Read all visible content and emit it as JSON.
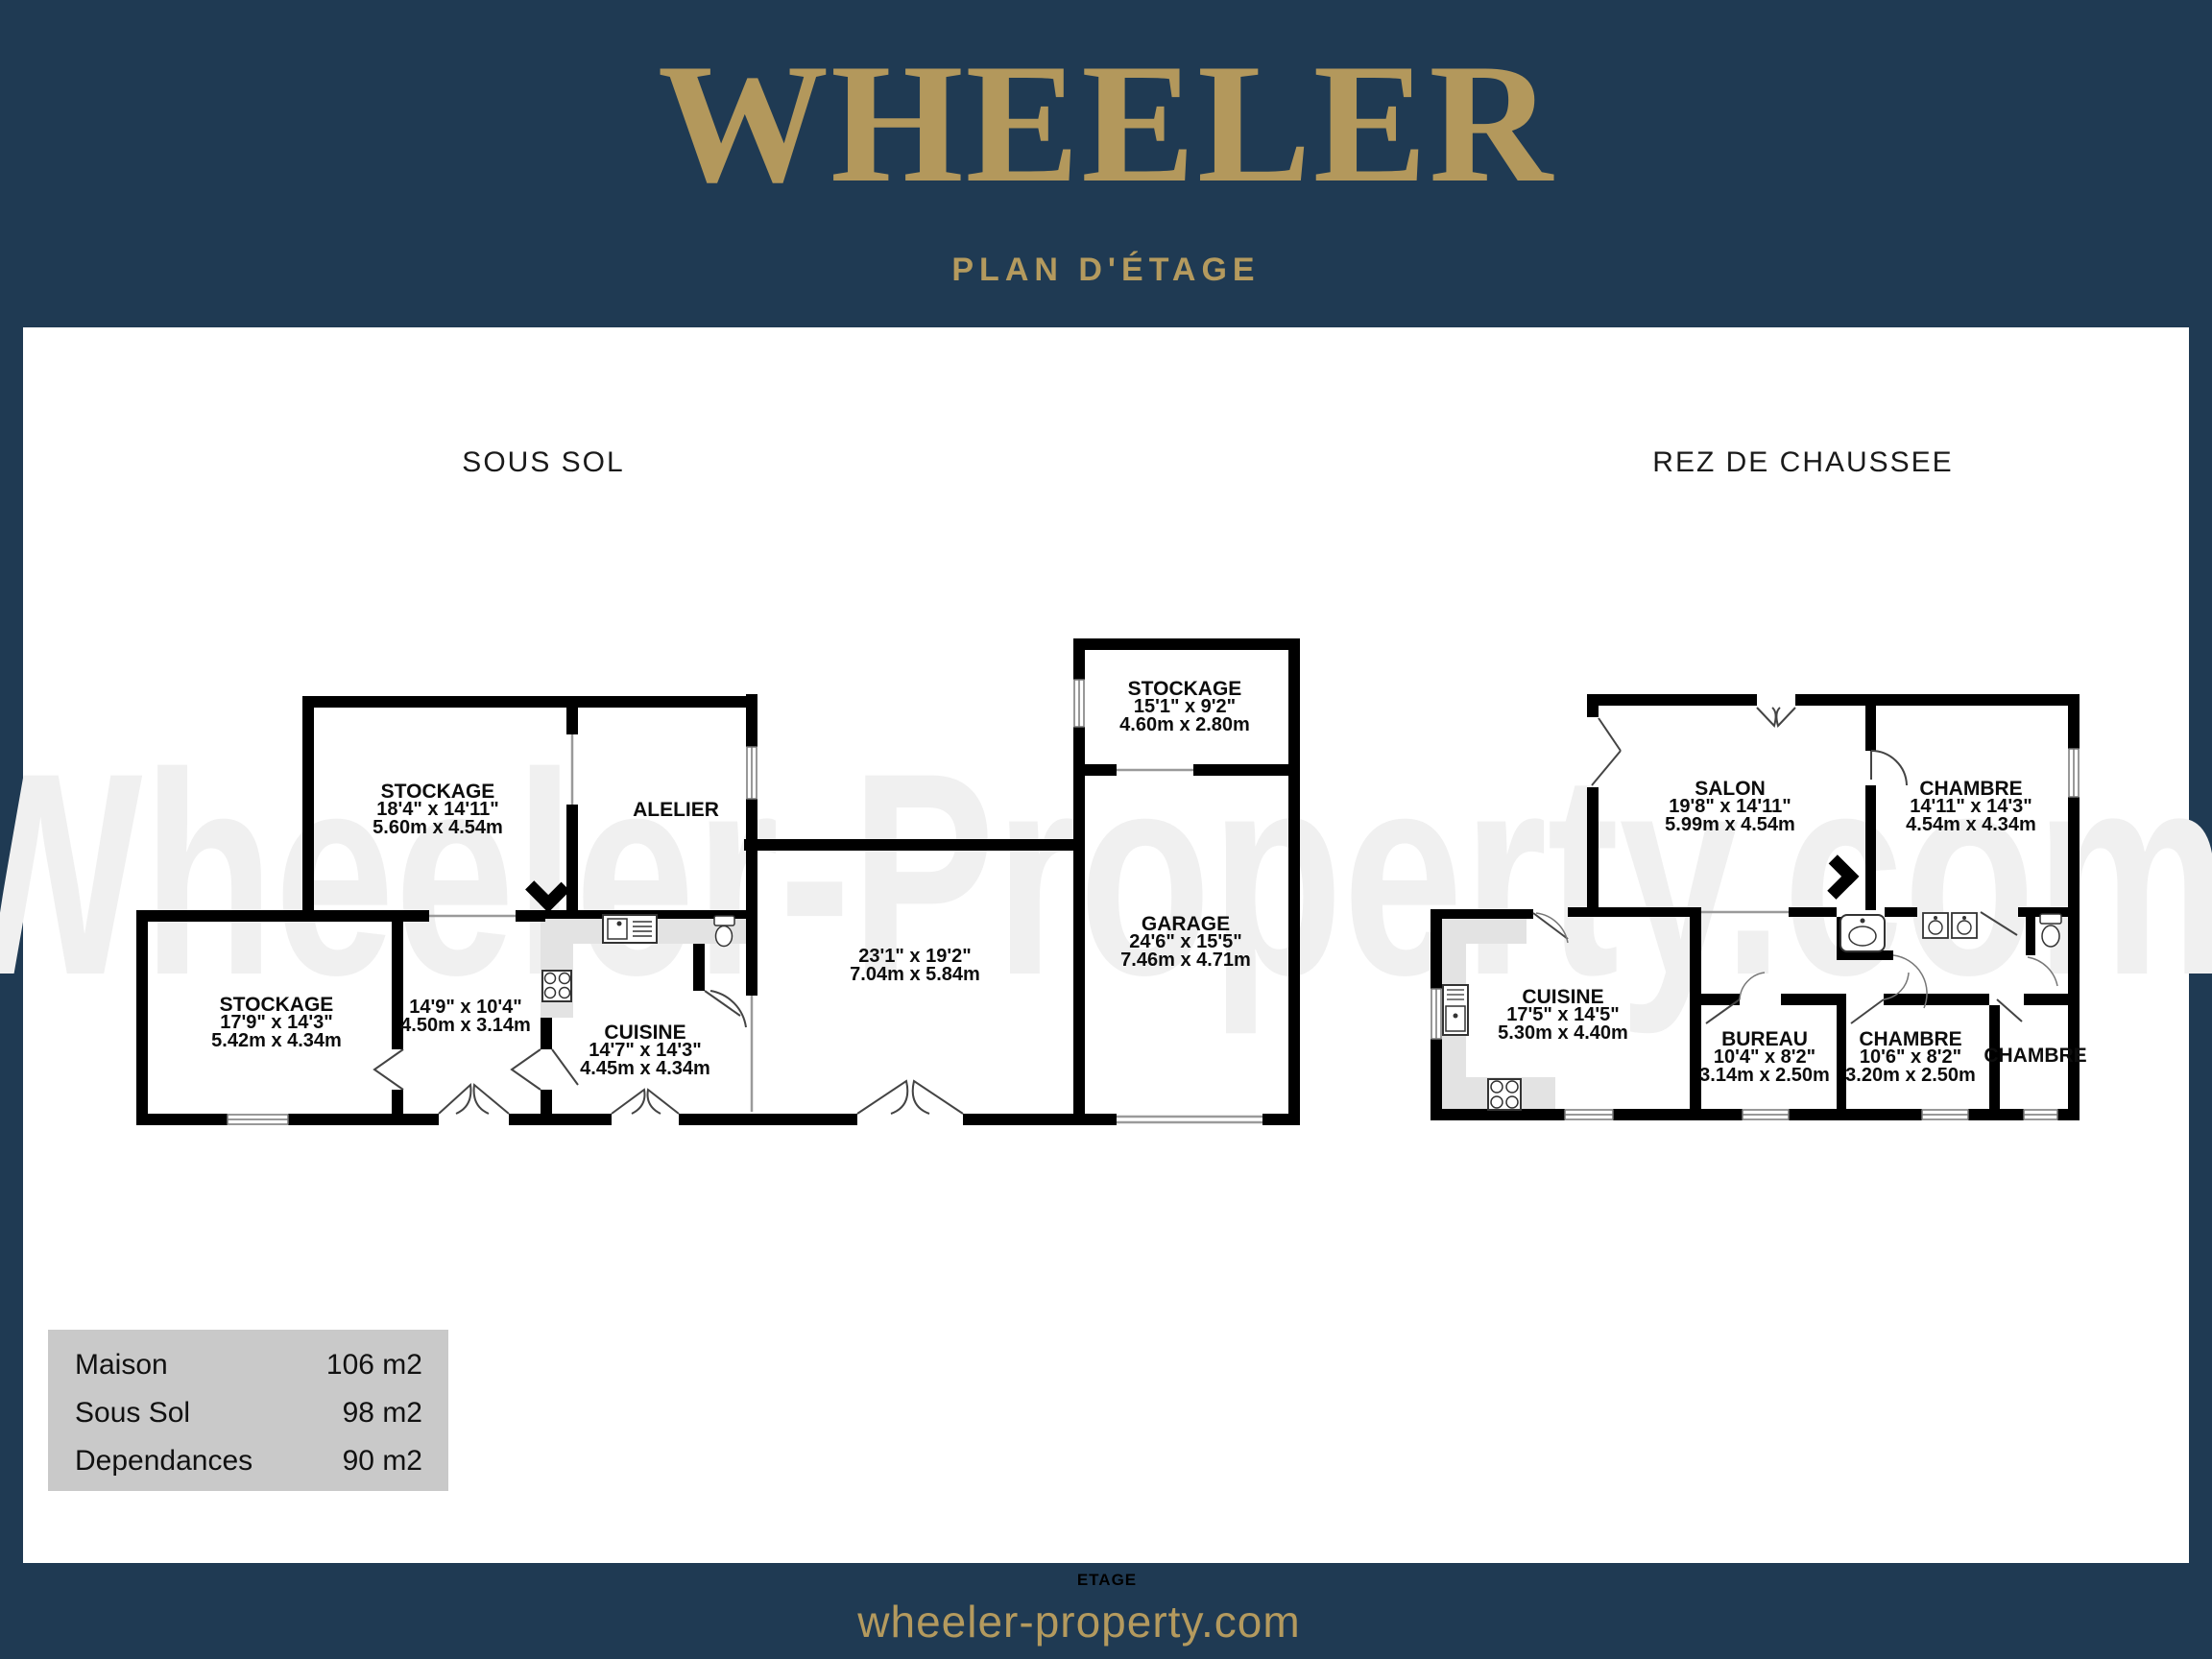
{
  "header": {
    "title": "WHEELER",
    "subtitle": "PLAN D'ÉTAGE"
  },
  "watermark": {
    "text": "Wheeler-Property.com"
  },
  "plans": [
    {
      "title": "SOUS SOL",
      "rooms": [
        {
          "name": "STOCKAGE",
          "imperial": "18'4\"  x 14'11\"",
          "metric": "5.60m  x 4.54m"
        },
        {
          "name": "ALELIER",
          "imperial": "",
          "metric": ""
        },
        {
          "name": "STOCKAGE",
          "imperial": "17'9\"  x 14'3\"",
          "metric": "5.42m  x 4.34m"
        },
        {
          "name": "",
          "imperial": "14'9\"  x 10'4\"",
          "metric": "4.50m  x 3.14m"
        },
        {
          "name": "CUISINE",
          "imperial": "14'7\"  x 14'3\"",
          "metric": "4.45m  x 4.34m"
        },
        {
          "name": "",
          "imperial": "23'1\"  x 19'2\"",
          "metric": "7.04m  x 5.84m"
        },
        {
          "name": "STOCKAGE",
          "imperial": "15'1\"  x 9'2\"",
          "metric": "4.60m  x 2.80m"
        },
        {
          "name": "GARAGE",
          "imperial": "24'6\"  x 15'5\"",
          "metric": "7.46m  x 4.71m"
        }
      ]
    },
    {
      "title": "REZ DE CHAUSSEE",
      "rooms": [
        {
          "name": "SALON",
          "imperial": "19'8\"  x 14'11\"",
          "metric": "5.99m  x 4.54m"
        },
        {
          "name": "CHAMBRE",
          "imperial": "14'11\"  x 14'3\"",
          "metric": "4.54m  x 4.34m"
        },
        {
          "name": "CUISINE",
          "imperial": "17'5\"  x 14'5\"",
          "metric": "5.30m  x 4.40m"
        },
        {
          "name": "BUREAU",
          "imperial": "10'4\"  x 8'2\"",
          "metric": "3.14m  x 2.50m"
        },
        {
          "name": "CHAMBRE",
          "imperial": "10'6\"  x 8'2\"",
          "metric": "3.20m  x 2.50m"
        },
        {
          "name": "CHAMBRE",
          "imperial": "",
          "metric": ""
        }
      ]
    }
  ],
  "legend": {
    "rows": [
      {
        "label": "Maison",
        "value": "106 m2"
      },
      {
        "label": "Sous Sol",
        "value": "98 m2"
      },
      {
        "label": "Dependances",
        "value": "90 m2"
      }
    ]
  },
  "footer": {
    "floor_label": "ETAGE",
    "url": "wheeler-property.com"
  },
  "colors": {
    "navy": "#1f3a53",
    "gold": "#b3985c",
    "wall": "#000000",
    "counter": "#e3e3e3",
    "legend_bg": "#c9c9c9"
  }
}
